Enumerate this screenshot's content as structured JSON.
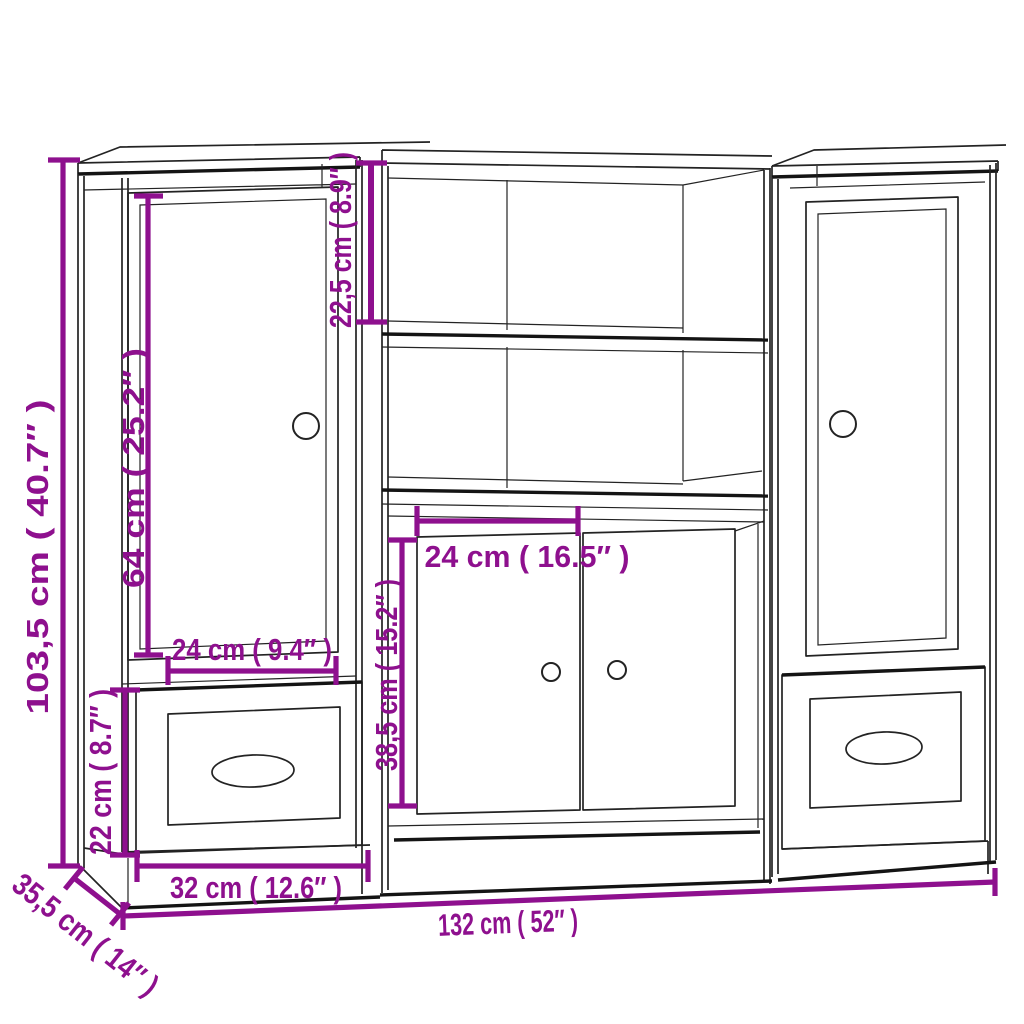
{
  "diagram": {
    "type": "furniture-dimension-drawing",
    "subject": "highboard set of three cabinets with shelves, doors and drawers",
    "background": "#ffffff",
    "accent_color": "#8e108e",
    "line_color": "#232323",
    "dimensions": [
      {
        "id": "total-height",
        "label": "103,5 cm ( 40.7″ )",
        "orientation": "vertical"
      },
      {
        "id": "side-door-height",
        "label": "64 cm ( 25.2″ )",
        "orientation": "vertical"
      },
      {
        "id": "top-compartment-height",
        "label": "22,5 cm ( 8.9″ )",
        "orientation": "vertical"
      },
      {
        "id": "side-door-width",
        "label": "24 cm ( 9.4″ )",
        "orientation": "horizontal"
      },
      {
        "id": "drawer-height",
        "label": "22 cm ( 8.7″ )",
        "orientation": "vertical"
      },
      {
        "id": "side-unit-width",
        "label": "32 cm ( 12.6″ )",
        "orientation": "horizontal"
      },
      {
        "id": "middle-door-width",
        "label": "24 cm ( 16.5″ )",
        "orientation": "horizontal"
      },
      {
        "id": "middle-door-height",
        "label": "38,5 cm ( 15.2″ )",
        "orientation": "vertical"
      },
      {
        "id": "depth",
        "label": "35,5 cm ( 14″ )",
        "orientation": "diagonal"
      },
      {
        "id": "total-width",
        "label": "132 cm ( 52″ )",
        "orientation": "horizontal"
      }
    ]
  }
}
